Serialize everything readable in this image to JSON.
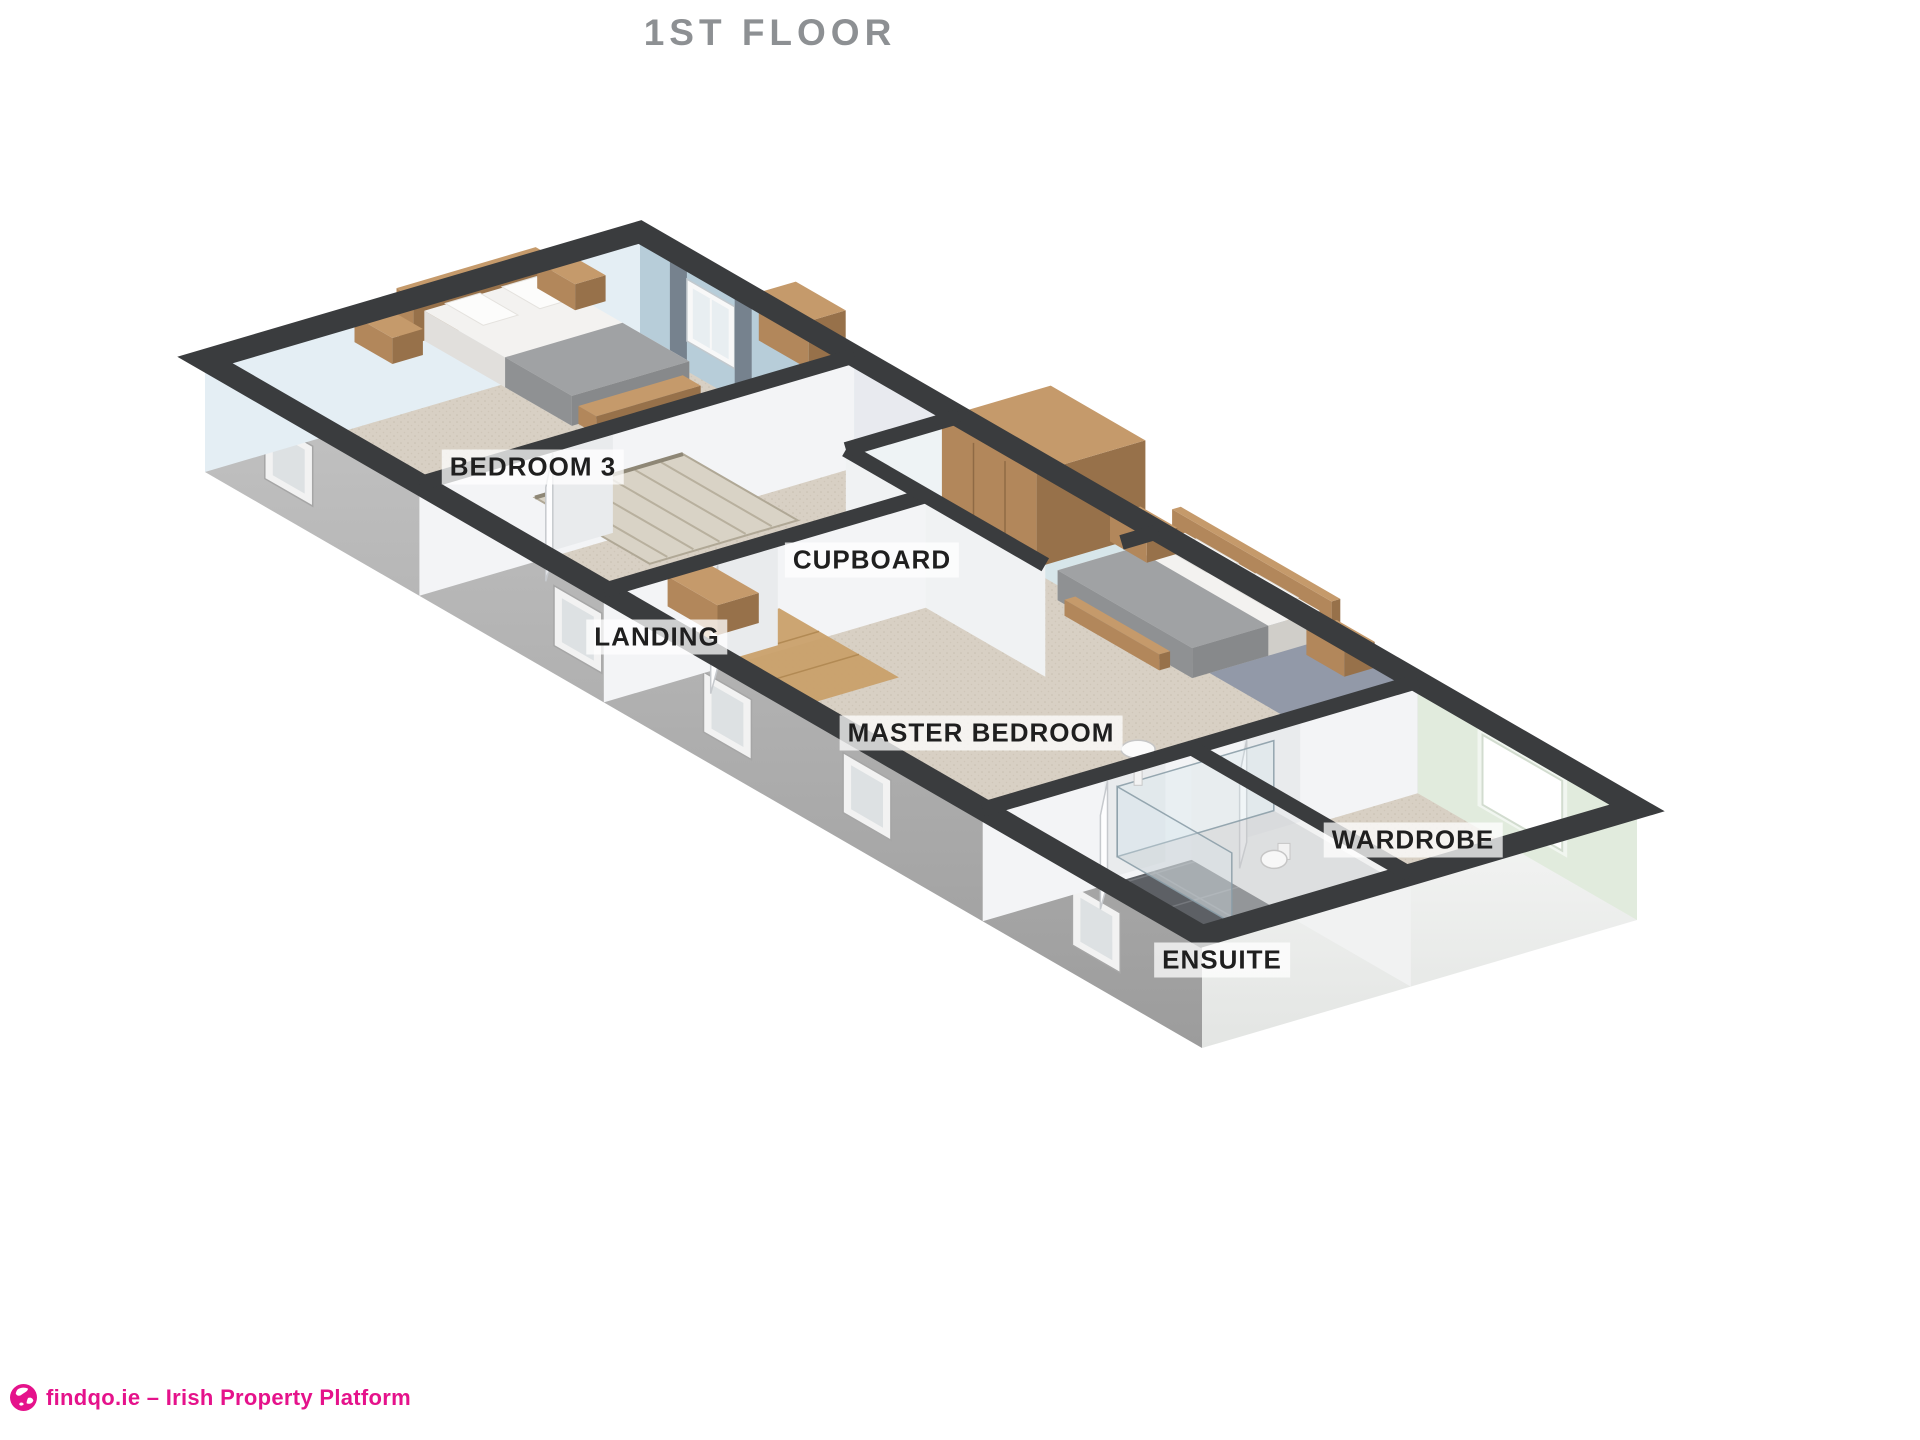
{
  "title": "1ST FLOOR",
  "floorplan": {
    "rooms": [
      {
        "name": "BEDROOM 3"
      },
      {
        "name": "LANDING"
      },
      {
        "name": "CUPBOARD"
      },
      {
        "name": "MASTER BEDROOM"
      },
      {
        "name": "WARDROBE"
      },
      {
        "name": "ENSUITE"
      }
    ]
  },
  "footer": {
    "text": "findqo.ie – Irish Property Platform"
  },
  "colors": {
    "wall_top": "#3a3c3e",
    "carpet": "#d8d0c4",
    "ensuite_floor": "#5d6065",
    "exterior_gray": "#b4b4b4",
    "end_wall_white": "#eef0ee",
    "bedroom3_wall": "#e4eef4",
    "bedroom3_wall_dark": "#b7cdd9",
    "landing_wall": "#e8eaef",
    "cupboard_wall": "#d7e6ea",
    "master_wall": "#9299a8",
    "wardrobe_wall": "#e1ebdd",
    "partition_white": "#f3f4f6",
    "wood": "#c59a6b",
    "brand_pink": "#e5128b",
    "title_gray": "#8d9093"
  }
}
